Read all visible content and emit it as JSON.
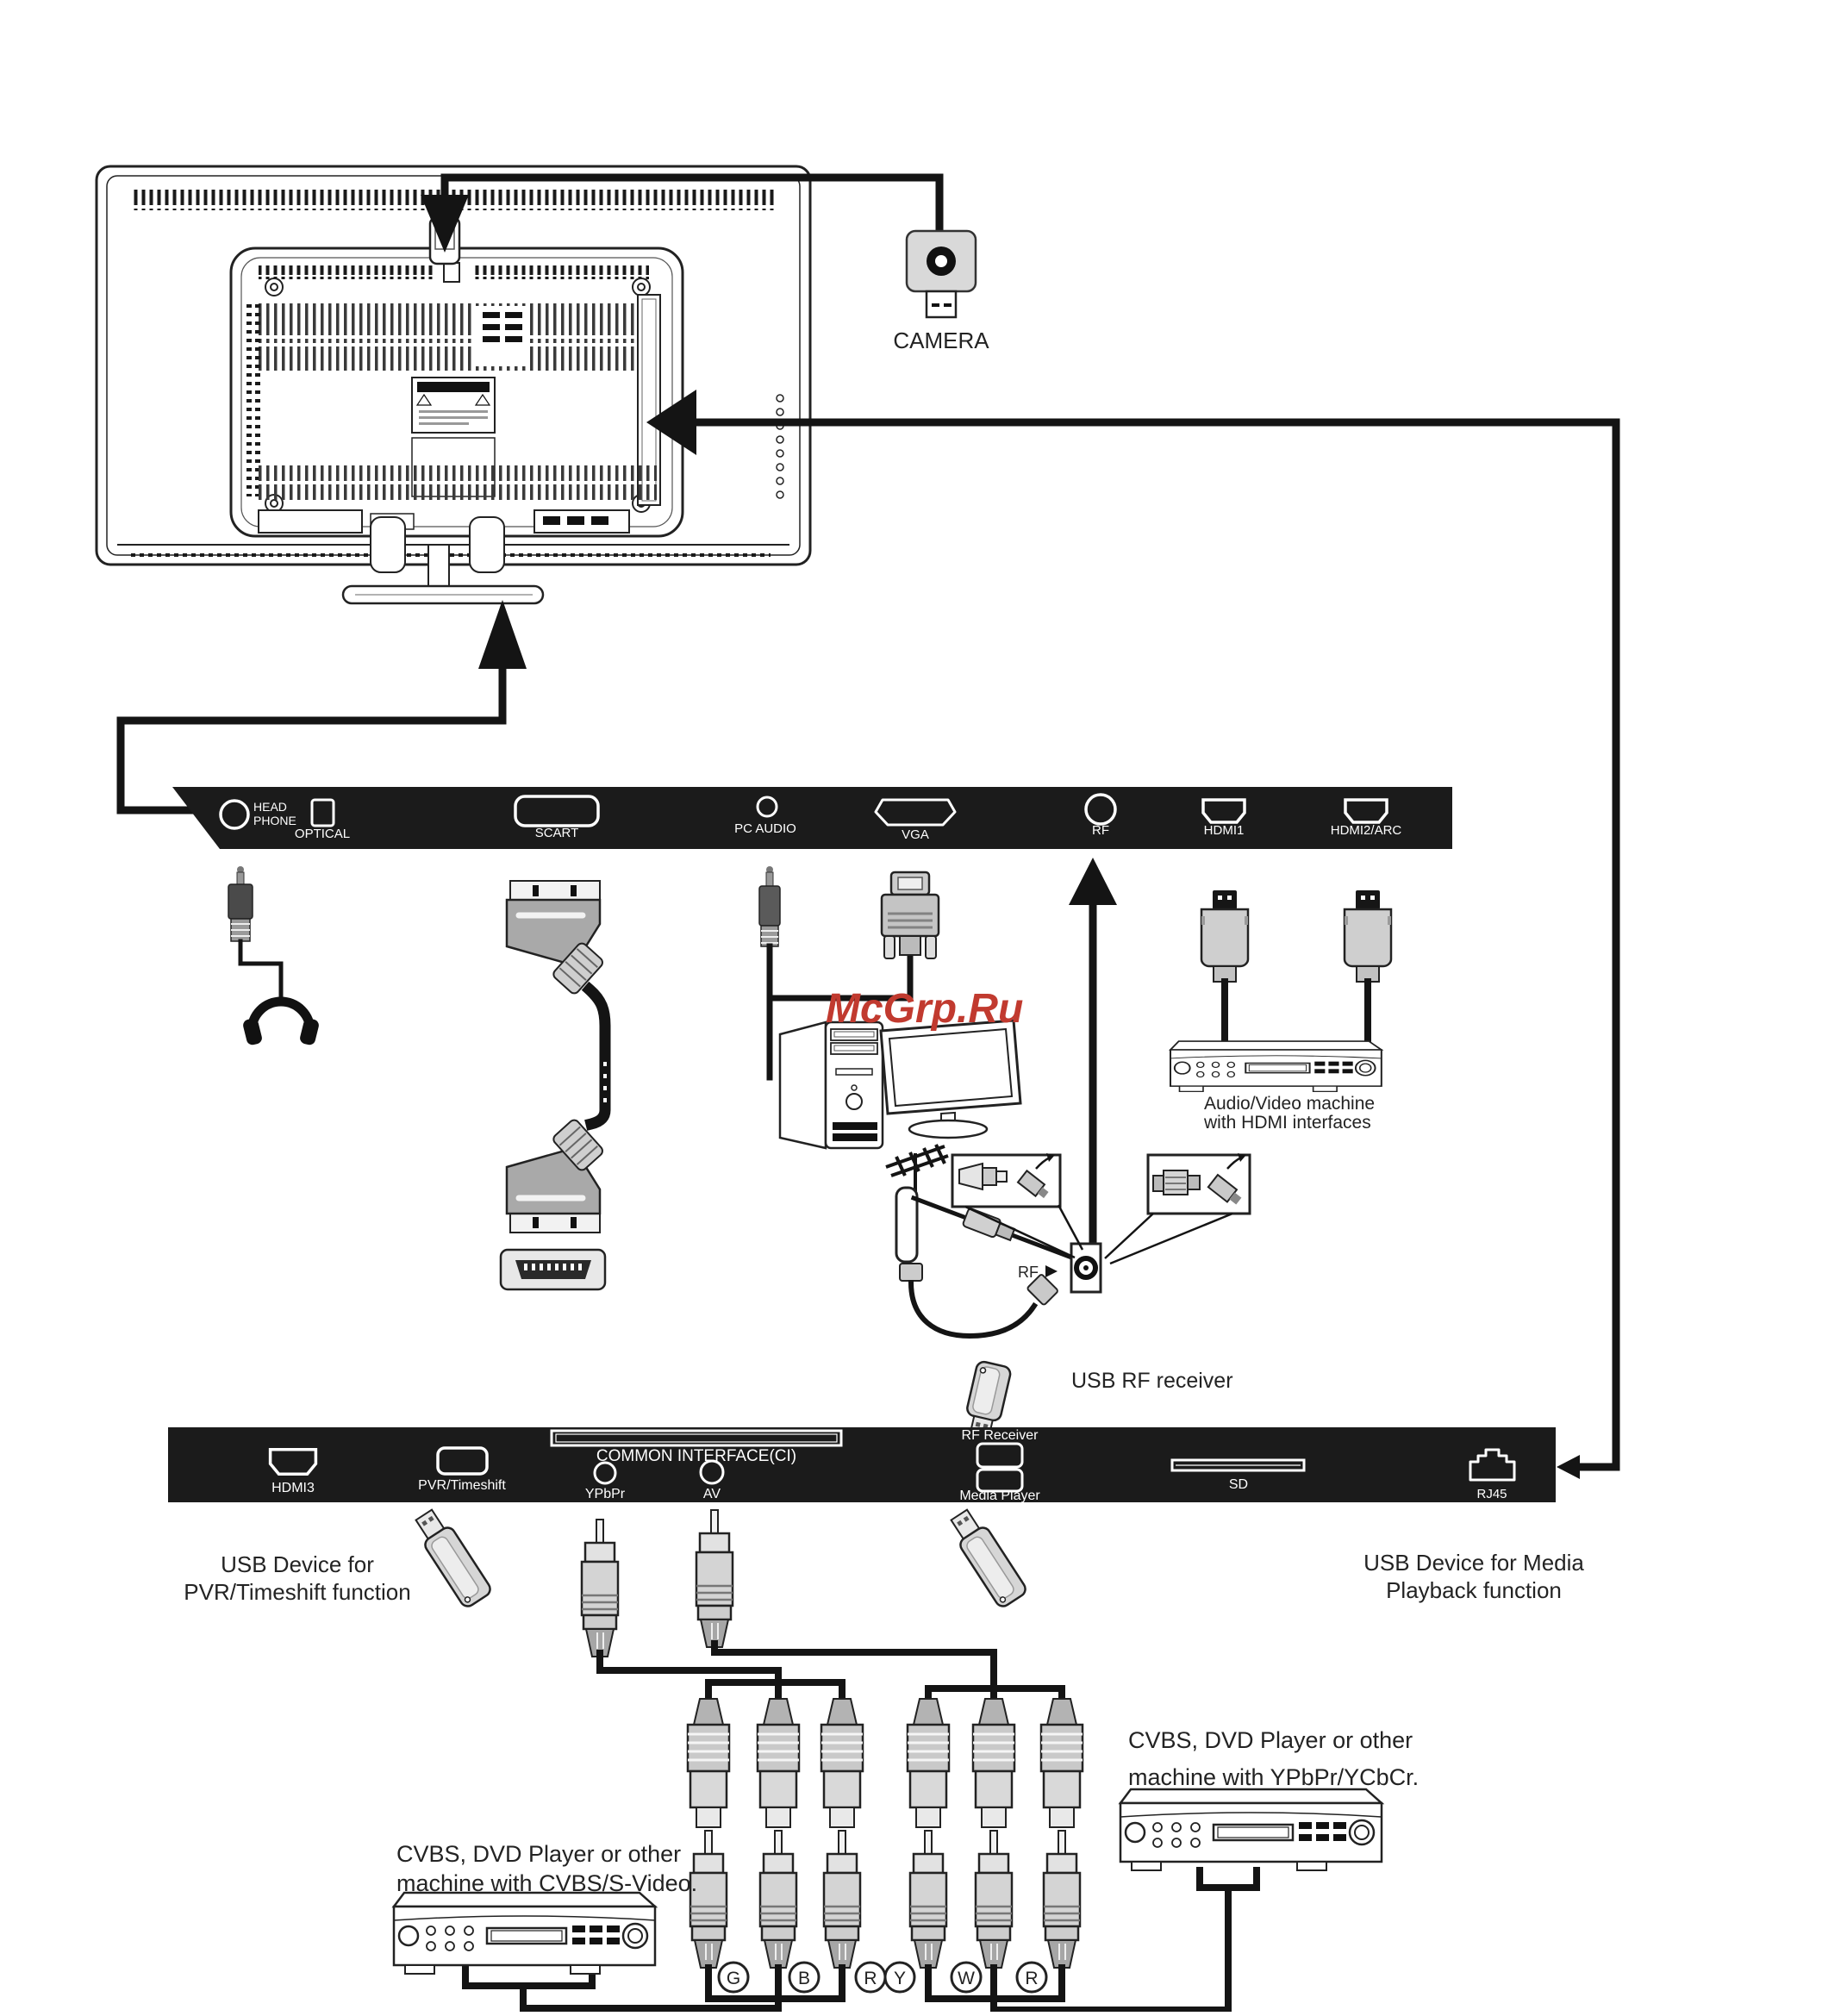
{
  "watermark": "McGrp.Ru",
  "camera": {
    "label": "CAMERA"
  },
  "rear_panel_top": {
    "headphone": [
      "HEAD",
      "PHONE"
    ],
    "optical": "OPTICAL",
    "scart": "SCART",
    "pc_audio": "PC AUDIO",
    "vga": "VGA",
    "rf": "RF",
    "hdmi1": "HDMI1",
    "hdmi2": "HDMI2/ARC"
  },
  "rear_panel_bottom": {
    "hdmi3": "HDMI3",
    "pvr": "PVR/Timeshift",
    "common_interface": "COMMON INTERFACE(CI)",
    "ypbpr": "YPbPr",
    "av": "AV",
    "rf_receiver": "RF Receiver",
    "media_player": "Media Player",
    "sd": "SD",
    "rj45": "RJ45"
  },
  "annotations": {
    "rf_input": "RF",
    "usb_rf_receiver": "USB RF receiver",
    "av_machine": [
      "Audio/Video machine",
      "with HDMI interfaces"
    ],
    "usb_pvr": [
      "USB Device for",
      "PVR/Timeshift function"
    ],
    "usb_media": [
      "USB Device for Media",
      "Playback function"
    ],
    "dvd_cvbs": [
      "CVBS, DVD Player or other",
      "machine with CVBS/S-Video."
    ],
    "dvd_ypbpr": [
      "CVBS, DVD  Player or other",
      "machine with YPbPr/YCbCr."
    ]
  },
  "rca_labels": [
    "G",
    "B",
    "R",
    "Y",
    "W",
    "R"
  ],
  "colors": {
    "panel": "#1b1b1b",
    "line": "#141414",
    "watermark": "#c13a2f",
    "connector": "#d4d4d4"
  }
}
